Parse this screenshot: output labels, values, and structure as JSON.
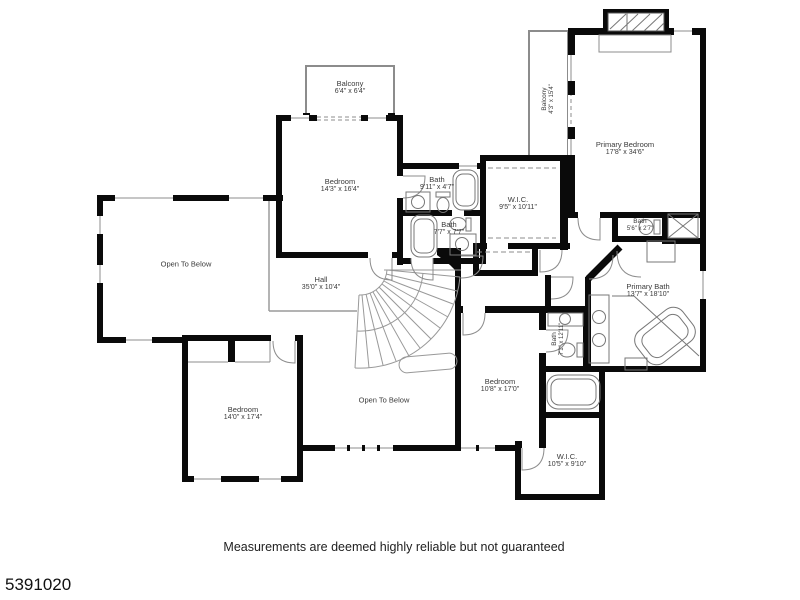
{
  "floorplan": {
    "disclaimer": "Measurements are deemed highly reliable but not guaranteed",
    "listing_id": "5391020",
    "colors": {
      "wall": "#0a0a0a",
      "thin_line": "#8c8c8c",
      "text": "#3a3a3a"
    },
    "rooms": [
      {
        "name": "Balcony",
        "dims": "6'4\" x 6'4\""
      },
      {
        "name": "Bedroom",
        "dims": "14'3\" x 16'4\""
      },
      {
        "name": "Bath",
        "dims": "9'11\" x 4'7\""
      },
      {
        "name": "Bath",
        "dims": "7'7\" x 7'7\""
      },
      {
        "name": "W.I.C.",
        "dims": "9'5\" x 10'11\""
      },
      {
        "name": "Balcony",
        "dims": "4'3\" x 15'4\""
      },
      {
        "name": "Primary Bedroom",
        "dims": "17'8\" x 34'6\""
      },
      {
        "name": "Bath",
        "dims": "5'6\" x 2'7\""
      },
      {
        "name": "Primary Bath",
        "dims": "13'7\" x 18'10\""
      },
      {
        "name": "Open To Below",
        "dims": ""
      },
      {
        "name": "Hall",
        "dims": "35'0\" x 10'4\""
      },
      {
        "name": "Bedroom",
        "dims": "14'0\" x 17'4\""
      },
      {
        "name": "Open To Below",
        "dims": ""
      },
      {
        "name": "Bedroom",
        "dims": "10'8\" x 17'0\""
      },
      {
        "name": "Bath",
        "dims": "7'1\" x 12'11\""
      },
      {
        "name": "W.I.C.",
        "dims": "10'5\" x 9'10\""
      }
    ]
  }
}
